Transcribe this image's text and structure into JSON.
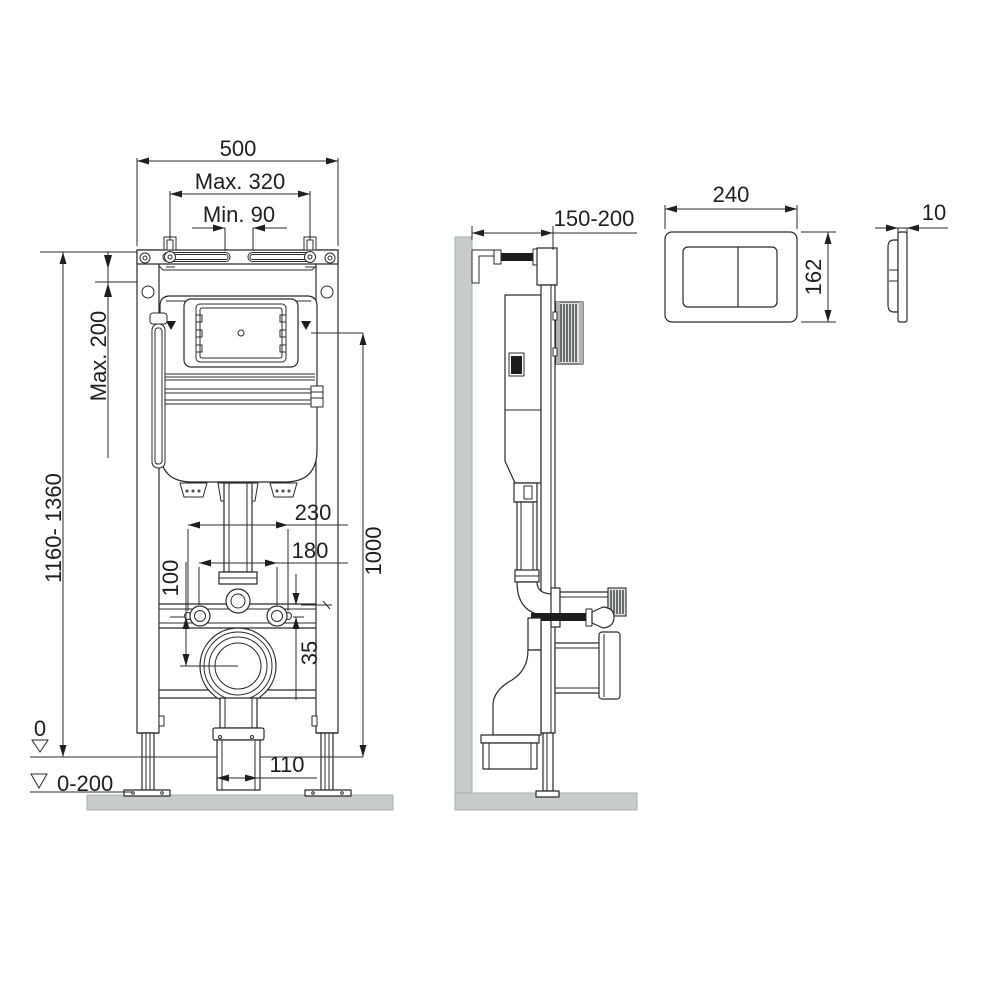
{
  "drawing": {
    "type": "technical-installation-diagram",
    "colors": {
      "line": "#2b2b2b",
      "text": "#1f1f1f",
      "wall_fill": "#c6cccb",
      "dark_fill": "#1c1c1c",
      "background": "#ffffff"
    },
    "front_view": {
      "dims": {
        "width_500": "500",
        "anchors_max": "Max. 320",
        "anchors_min": "Min. 90",
        "top_offset_max": "Max. 200",
        "frame_height_range": "1160- 1360",
        "ref_height_1000": "1000",
        "fixing_230": "230",
        "fixing_180": "180",
        "drain_offset_100": "100",
        "rail_offset_35": "35",
        "outlet_width_110": "110",
        "floor_level_zero": "0",
        "floor_adjust_range": "0-200"
      }
    },
    "side_view": {
      "dims": {
        "wall_distance_range": "150-200"
      }
    },
    "flush_plate_front": {
      "dims": {
        "width_240": "240",
        "height_162": "162"
      }
    },
    "flush_plate_side": {
      "dims": {
        "thickness_10": "10"
      }
    }
  }
}
